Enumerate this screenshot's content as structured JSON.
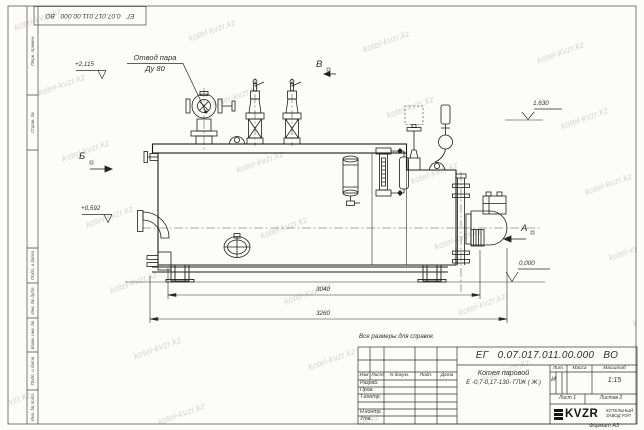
{
  "watermark": {
    "text": "kotel-kvzr.kz"
  },
  "margin_labels": [
    "Перв. примен.",
    "Справ. №",
    "Подп. и дата",
    "Инв. № дубл.",
    "Взам. инв. №",
    "Подп. и дата",
    "Инв. № подл."
  ],
  "drawing": {
    "steam_outlet_line1": "Отвод пара",
    "steam_outlet_line2": "Ду 80",
    "elev_top": "+2,115",
    "elev_mid": "+0,592",
    "elev_right": "1,630",
    "elev_zero": "0,000",
    "view_a": "А",
    "view_b": "Б",
    "view_v": "В",
    "dim_inner": "3040",
    "dim_outer": "3260",
    "note": "Все размеры для справок"
  },
  "title_block": {
    "doc_number": "ЕГ 0.07.017.011.00.000 ВО",
    "product_name_line1": "Котел паровой",
    "product_name_line2": "Е -0,7-0,17-130- ГЛЖ ( Ж )",
    "columns": [
      "Изм",
      "Лист",
      "N докум.",
      "Подп.",
      "Дата"
    ],
    "approval_rows": [
      "Разраб.",
      "Пров.",
      "Т.контр.",
      "Н.контр.",
      "Утв."
    ],
    "lit_header": "Лит.",
    "mass_header": "Масса",
    "scale_header": "Масштаб",
    "lit_value": "И",
    "scale_value": "1:15",
    "sheet_info": "Лист 1",
    "sheets_info": "Листов 2",
    "logo_text": "KVZR",
    "company": "КОТЕЛЬНЫЙ ЗАВОД РЭП",
    "format_label": "Формат А3"
  }
}
